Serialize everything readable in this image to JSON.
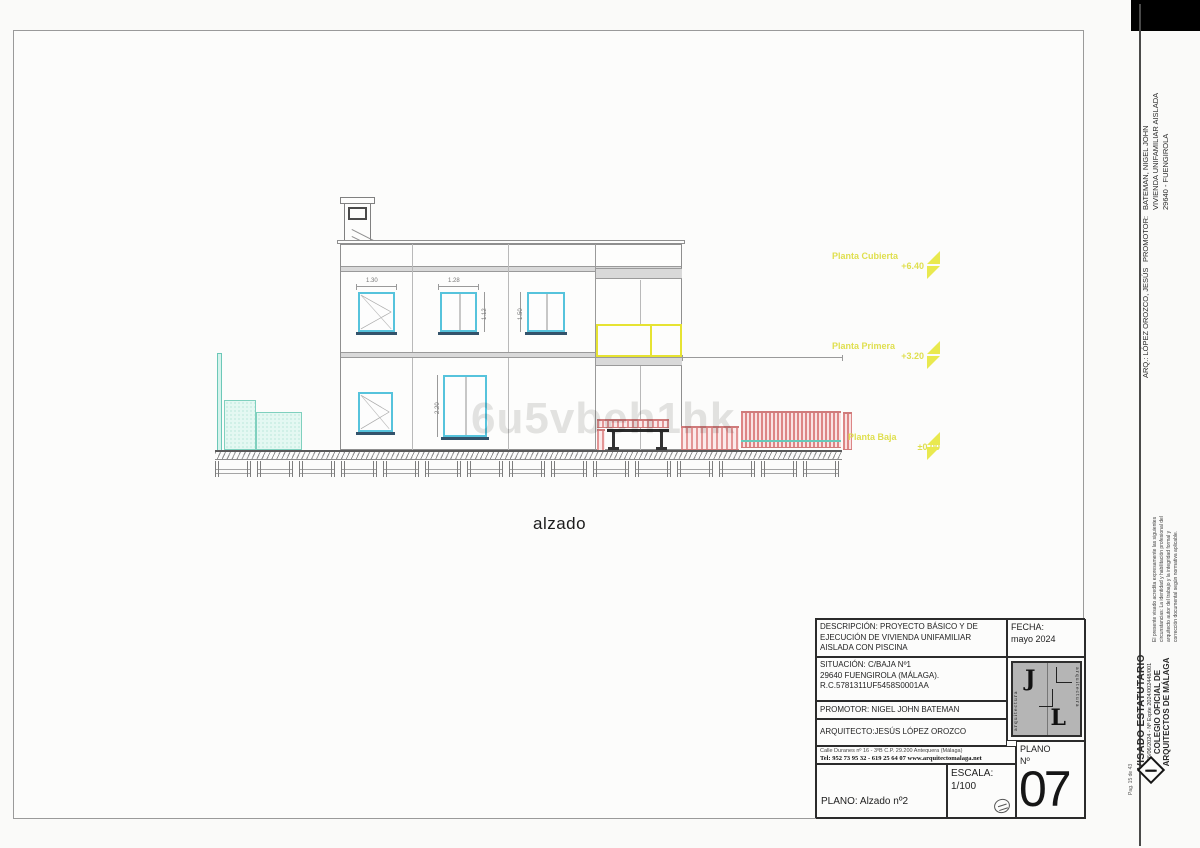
{
  "drawing": {
    "caption": "alzado",
    "watermark": "6u5vbeh1hk",
    "levels": [
      {
        "name": "Planta Cubierta",
        "value": "+6.40"
      },
      {
        "name": "Planta Primera",
        "value": "+3.20"
      },
      {
        "name": "Planta Baja",
        "value": "±0.00"
      }
    ],
    "dims": {
      "w1_width": "1.30",
      "w2_width": "1.28",
      "w2_height": "1.12",
      "w3_height": "1.50",
      "door_height": "2.20"
    }
  },
  "title_block": {
    "descripcion_line1": "DESCRIPCIÓN: PROYECTO BÁSICO Y DE",
    "descripcion_line2": "EJECUCIÓN DE VIVIENDA UNIFAMILIAR",
    "descripcion_line3": "AISLADA CON PISCINA",
    "fecha_label": "FECHA:",
    "fecha_value": "mayo  2024",
    "situacion_line1": "SITUACIÓN:  C/BAJA Nº1",
    "situacion_line2": "29640 FUENGIROLA (MÁLAGA).",
    "situacion_line3": "R.C.5781311UF5458S0001AA",
    "promotor": "PROMOTOR: NIGEL JOHN BATEMAN",
    "arquitecto": "ARQUITECTO:JESÚS LÓPEZ OROZCO",
    "address_line1": "Calle Duranes nº 16 - 3ºB      C.P. 29.200      Antequera (Málaga)",
    "address_line2": "Tel: 952 73 95 32 - 619 25 64 07 www.arquitectomalaga.net",
    "plano_name": "PLANO: Alzado nº2",
    "escala_label": "ESCALA:",
    "escala_value": "1/100",
    "plano_num_label": "PLANO",
    "plano_num_sub": "Nº",
    "plano_num": "07",
    "logo_letter_1": "J",
    "logo_letter_2": "L",
    "logo_side_text": "arquitectura"
  },
  "sidebar": {
    "promotor_label": "PROMOTOR:",
    "promotor_line1": "BATEMAN, NIGEL JOHN",
    "promotor_line2": "VIVIENDA UNIFAMILIAR AISLADA",
    "promotor_line3": "29640 - FUENGIROLA",
    "arquitecto": "ARQ.: LÓPEZ OROZCO, JESÚS",
    "note_line1": "El presente visado acredita expresamente las siguientes",
    "note_line2": "circunstancias: La identidad y habilitación profesional del",
    "note_line3": "arquitecto autor del trabajo y la integridad formal y",
    "note_line4": "corrección documental según normativa aplicable.",
    "visado_title": "VISADO ESTATUTARIO",
    "visado_expte": "26/06/2024 - Nº Expte 2024/002448/001",
    "colegio_line1": "COLEGIO OFICIAL DE",
    "colegio_line2": "ARQUITECTOS DE MÁLAGA",
    "page_note": "Pag. 15 de 43"
  },
  "colors": {
    "window_frame": "#56c3dc",
    "sill": "#33536b",
    "teal": "#7fd0be",
    "pink_fence": "#dd8585",
    "level_yellow": "#e9e94f",
    "slab_gray": "#d9d9d9"
  }
}
